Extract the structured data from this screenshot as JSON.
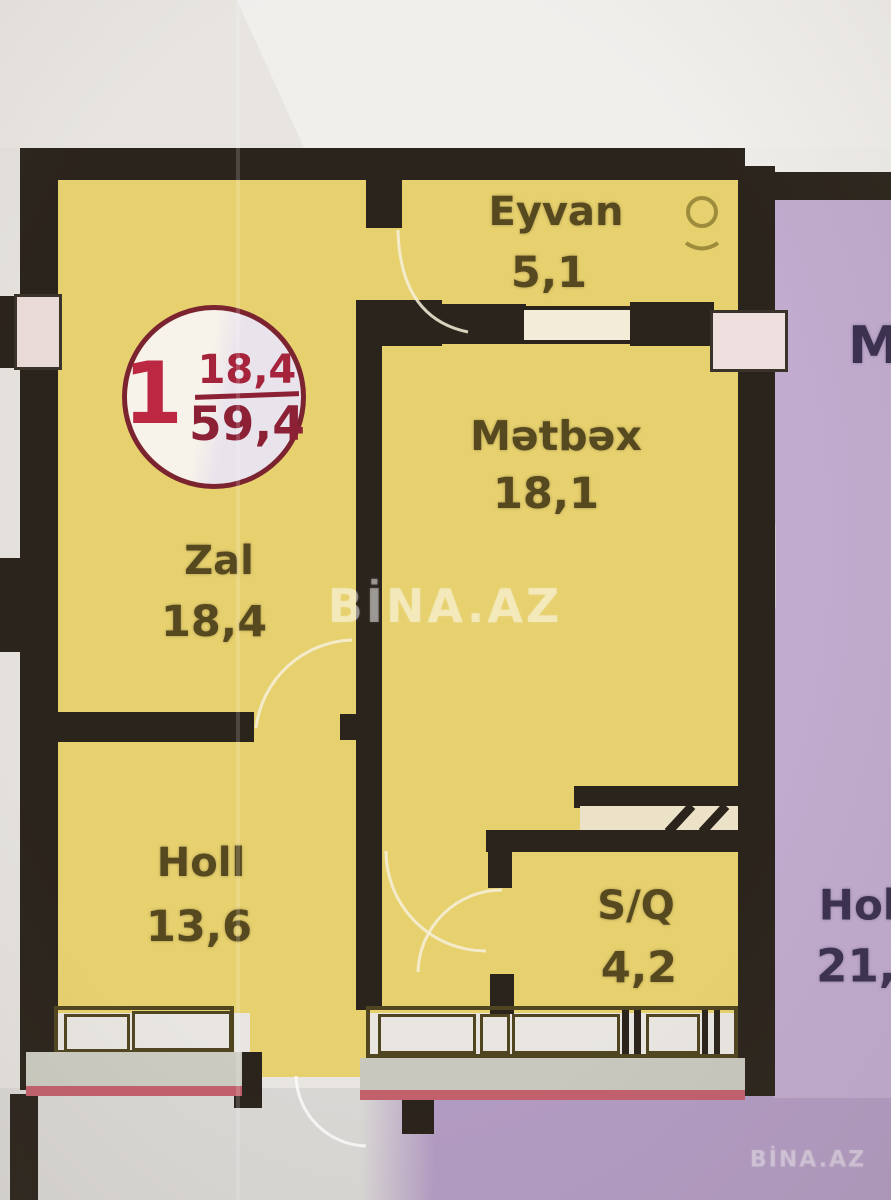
{
  "plan": {
    "type": "apartment-floor-plan",
    "watermark_center": "BİNA.AZ",
    "watermark_corner": "BİNA.AZ"
  },
  "badge": {
    "unit_number": "1",
    "living_area": "18,4",
    "total_area": "59,4"
  },
  "rooms": [
    {
      "id": "eyvan",
      "label": "Eyvan",
      "area": "5,1"
    },
    {
      "id": "metbex",
      "label": "Mətbəx",
      "area": "18,1"
    },
    {
      "id": "zal",
      "label": "Zal",
      "area": "18,4"
    },
    {
      "id": "holl",
      "label": "Holl",
      "area": "13,6"
    },
    {
      "id": "sq",
      "label": "S/Q",
      "area": "4,2"
    }
  ],
  "neighbor_rooms": [
    {
      "id": "neighbor-kitchen",
      "label": "M"
    },
    {
      "id": "neighbor-hall",
      "label": "Hol",
      "area": "21,"
    }
  ],
  "icons": {
    "eyvan_symbol": "circle-with-arc"
  },
  "colors": {
    "apartment_fill": "#e7d16f",
    "neighbor_fill": "#c1abce",
    "wall": "#2b241c",
    "badge_red": "#bc2742",
    "badge_border": "#7b2430",
    "label_text": "#57491f",
    "sill_pink": "#c2606c",
    "watermark": "#ffffff"
  }
}
